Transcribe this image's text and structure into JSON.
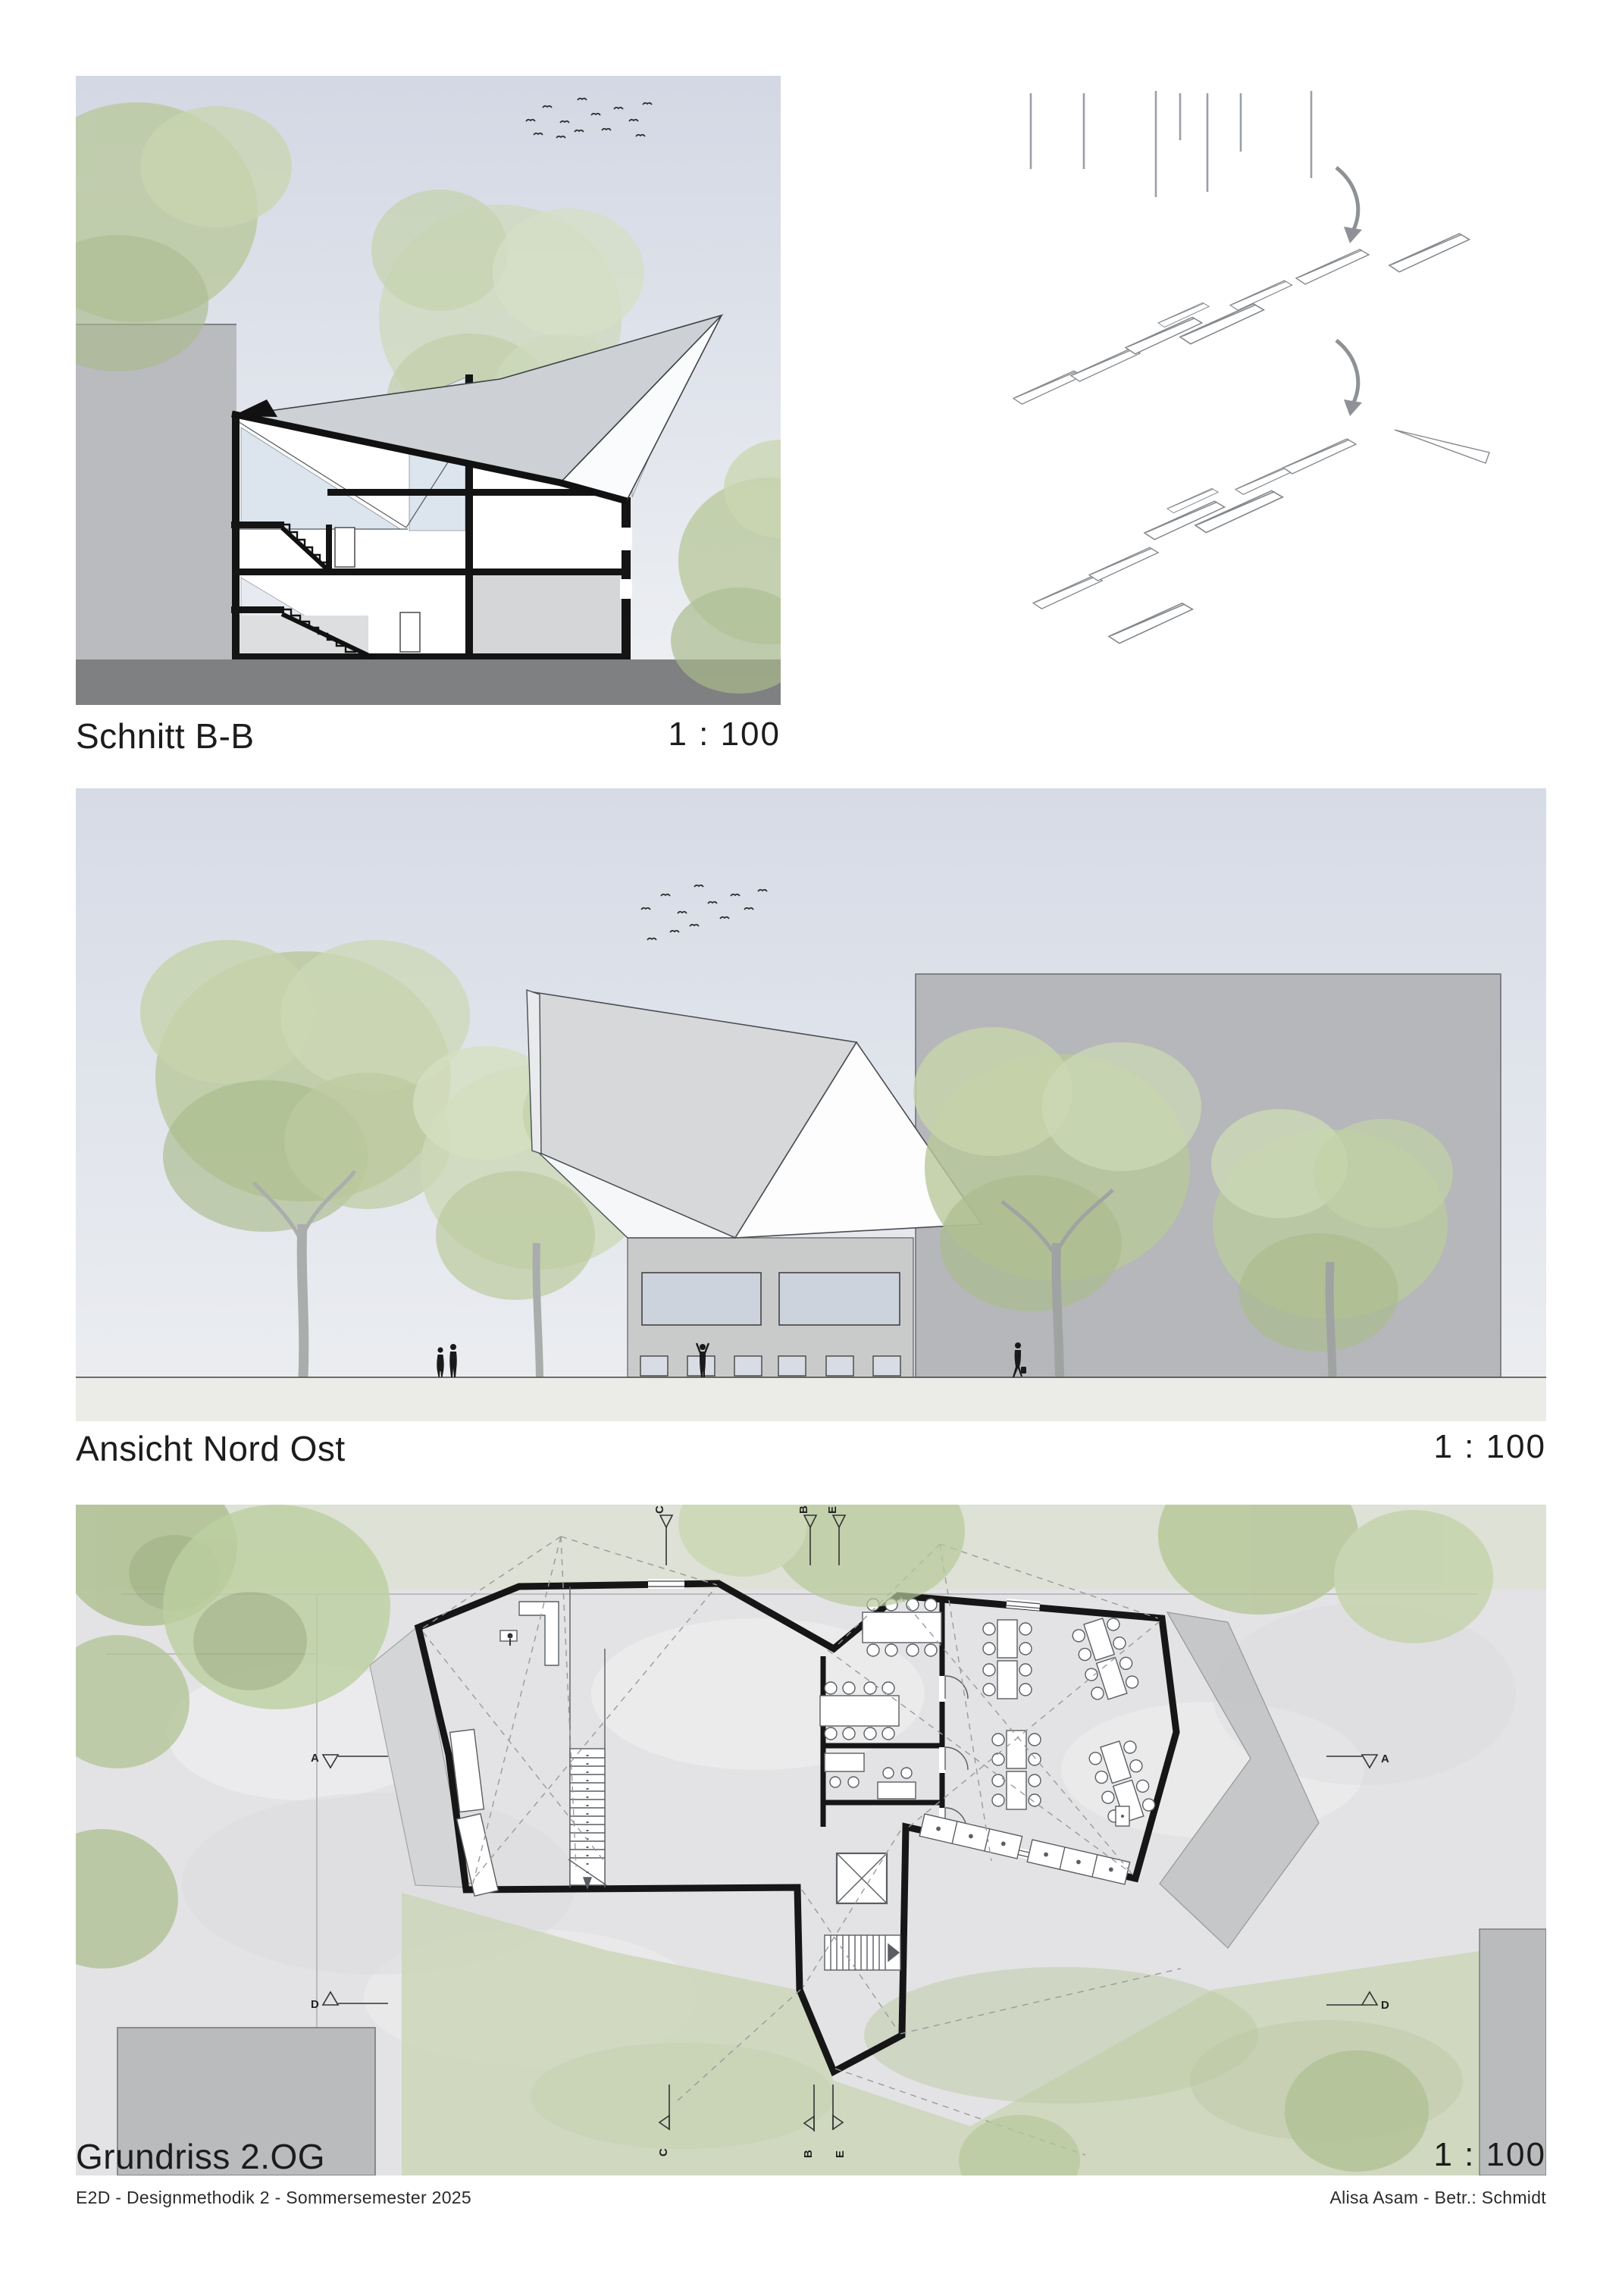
{
  "panels": {
    "section": {
      "title": "Schnitt B-B",
      "scale": "1 : 100"
    },
    "elevation": {
      "title": "Ansicht Nord Ost",
      "scale": "1 : 100"
    },
    "plan": {
      "title": "Grundriss 2.OG",
      "scale": "1 : 100"
    }
  },
  "plan_markers": {
    "top": [
      "C",
      "B",
      "E"
    ],
    "bottom": [
      "C",
      "B",
      "E"
    ],
    "left_a": "A",
    "right_a": "A",
    "left_d": "D",
    "right_d": "D"
  },
  "footer": {
    "left": "E2D - Designmethodik 2 - Sommersemester 2025",
    "right": "Alisa Asam - Betr.: Schmidt"
  },
  "colors": {
    "sky": "#d8dde8",
    "sky_light": "#edeff3",
    "tree_green": "#b9c89b",
    "tree_green_light": "#ccd8b4",
    "building_grey": "#b7b9bc",
    "facade_grey": "#c9cbca",
    "roof_grey": "#cdd0d4",
    "ground_dark": "#7e8081",
    "paving": "#e3e3e5",
    "lawn": "#ccd6ba",
    "glass": "#dce5ee",
    "wall_black": "#161616",
    "line_grey": "#8e9296"
  }
}
